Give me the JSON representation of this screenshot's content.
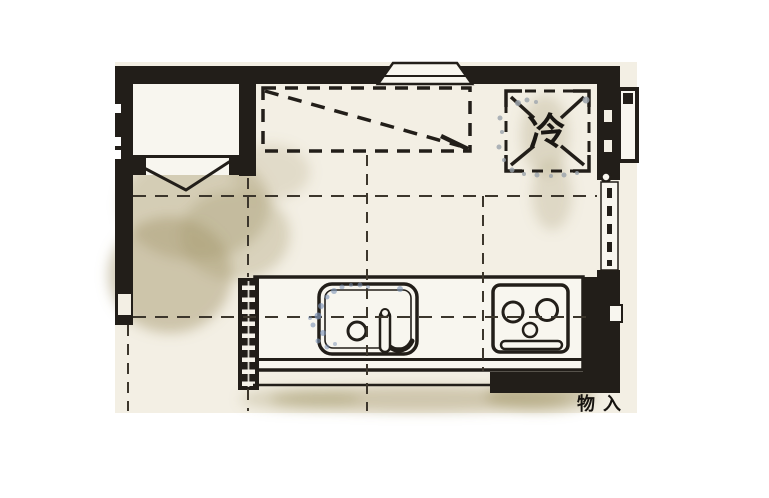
{
  "colors": {
    "background": "#ffffff",
    "paper": "#f3efe4",
    "paper_light": "#f8f6ef",
    "wall": "#221e19",
    "grid_dash": "#3c362c",
    "stain": "#a3976b",
    "speckle_blue": "#7c92b6",
    "speckle_gray": "#9aa2ab"
  },
  "labels": {
    "refrigerator": "冷",
    "closet": "物入"
  }
}
